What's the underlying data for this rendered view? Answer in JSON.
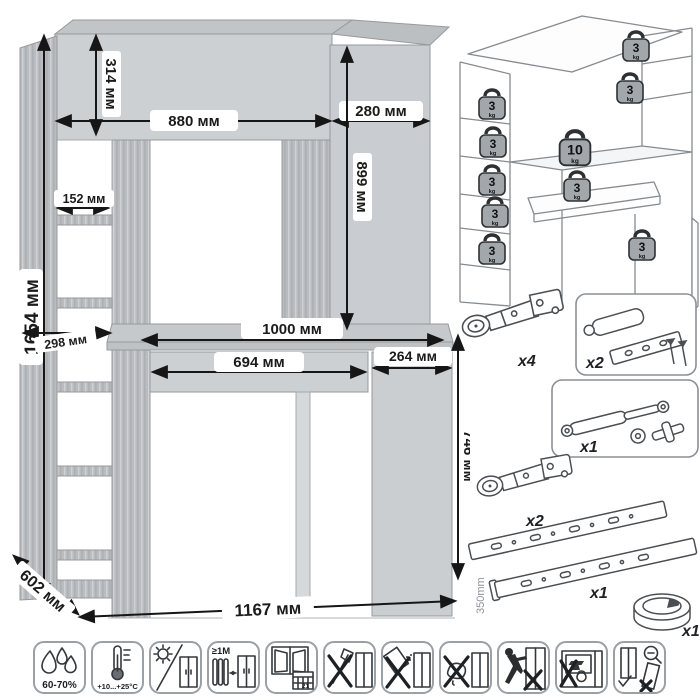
{
  "unit": "мм",
  "dimensions": {
    "total_height": "1654 мм",
    "hutch_height": "314 мм",
    "hutch_width": "880 мм",
    "top_cabinet_width": "280 мм",
    "top_cabinet_height": "899 мм",
    "shelf_depth": "152 мм",
    "shelf_width": "298 мм",
    "desktop_width": "1000 мм",
    "drawer_width": "694 мм",
    "door_width": "264 мм",
    "desk_height": "746 мм",
    "depth": "602 мм",
    "total_width": "1167 мм"
  },
  "load_diagram": {
    "weights": [
      {
        "location": "left-shelf-1",
        "value": "3",
        "unit": "kg"
      },
      {
        "location": "left-shelf-2",
        "value": "3",
        "unit": "kg"
      },
      {
        "location": "left-shelf-3",
        "value": "3",
        "unit": "kg"
      },
      {
        "location": "left-shelf-4",
        "value": "3",
        "unit": "kg"
      },
      {
        "location": "left-shelf-5",
        "value": "3",
        "unit": "kg"
      },
      {
        "location": "hutch-top-shelf",
        "value": "3",
        "unit": "kg"
      },
      {
        "location": "right-shelf",
        "value": "3",
        "unit": "kg"
      },
      {
        "location": "desktop",
        "value": "10",
        "unit": "kg"
      },
      {
        "location": "drawer",
        "value": "3",
        "unit": "kg"
      },
      {
        "location": "base-cabinet",
        "value": "3",
        "unit": "kg"
      }
    ]
  },
  "hardware": {
    "hinge_top": {
      "name": "concealed-hinge",
      "qty": "х4"
    },
    "damper": {
      "name": "door-damper-with-screws",
      "qty": "х2"
    },
    "gas_lift": {
      "name": "gas-lift-strut",
      "qty": "х1"
    },
    "hinge_bottom": {
      "name": "concealed-hinge",
      "qty": "х2"
    },
    "slides": {
      "name": "ball-bearing-drawer-slides",
      "qty": "x1",
      "length": "350mm"
    },
    "grommet": {
      "name": "cable-grommet",
      "qty": "x1"
    }
  },
  "care_icons": [
    {
      "name": "humidity",
      "label": "60-70%"
    },
    {
      "name": "temperature",
      "label": "+10...+25°С"
    },
    {
      "name": "no-direct-sunlight"
    },
    {
      "name": "heater-distance",
      "label": "≥1М"
    },
    {
      "name": "ventilation",
      "label": "21"
    },
    {
      "name": "no-sharp-impact"
    },
    {
      "name": "no-abrasives"
    },
    {
      "name": "no-wet-cleaning"
    },
    {
      "name": "no-dragging"
    },
    {
      "name": "no-heavy-load"
    },
    {
      "name": "assemble-upright"
    }
  ]
}
